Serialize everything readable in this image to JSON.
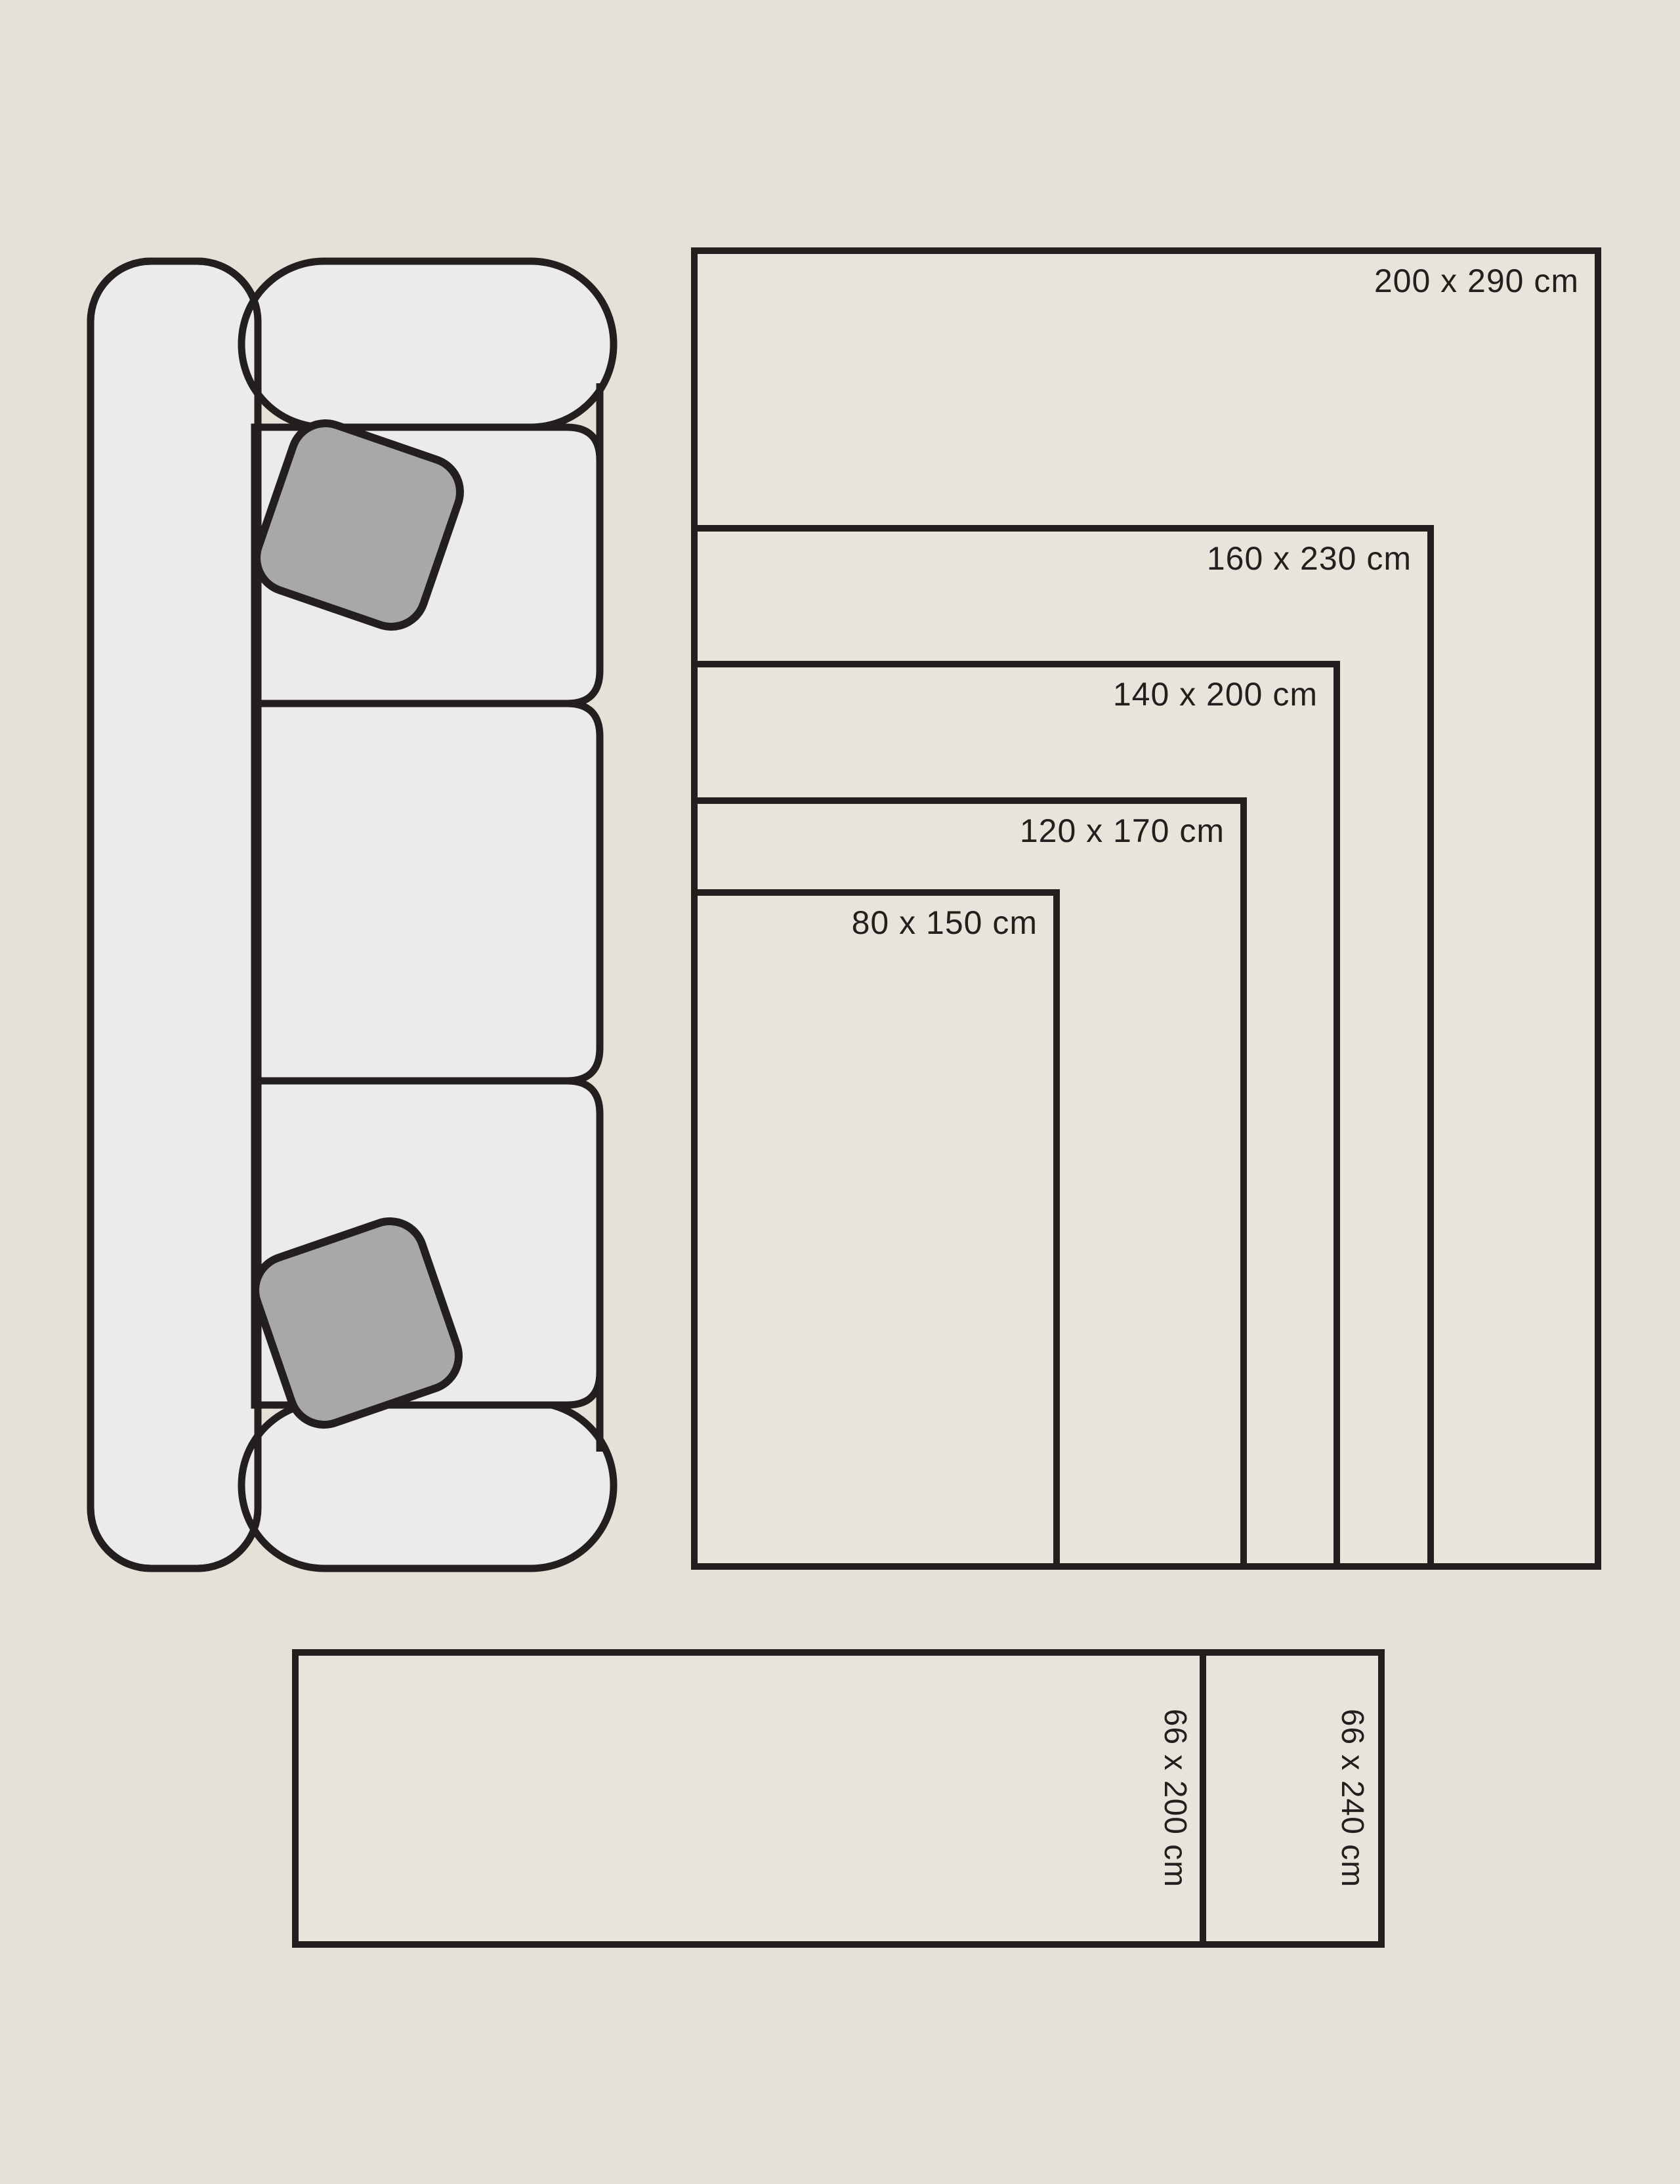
{
  "diagram": {
    "kind": "rug-size-guide",
    "units": "cm"
  },
  "colors": {
    "background": "#e6e1d8",
    "rug_fill": "#e9e4db",
    "outline": "#221f1e",
    "sofa_fill": "#ebebe9",
    "pillow_fill": "#a8a8a7"
  },
  "nested_rugs": [
    {
      "label": "200 x 290 cm",
      "width_cm": 200,
      "length_cm": 290
    },
    {
      "label": "160 x 230 cm",
      "width_cm": 160,
      "length_cm": 230
    },
    {
      "label": "140 x 200 cm",
      "width_cm": 140,
      "length_cm": 200
    },
    {
      "label": "120 x 170 cm",
      "width_cm": 120,
      "length_cm": 170
    },
    {
      "label": "80 x 150 cm",
      "width_cm": 80,
      "length_cm": 150
    }
  ],
  "runner_rugs": [
    {
      "label": "66 x 200 cm",
      "width_cm": 66,
      "length_cm": 200
    },
    {
      "label": "66 x 240 cm",
      "width_cm": 66,
      "length_cm": 240
    }
  ],
  "sofa": {
    "description": "three-seat sofa seen from above with two throw pillows"
  }
}
